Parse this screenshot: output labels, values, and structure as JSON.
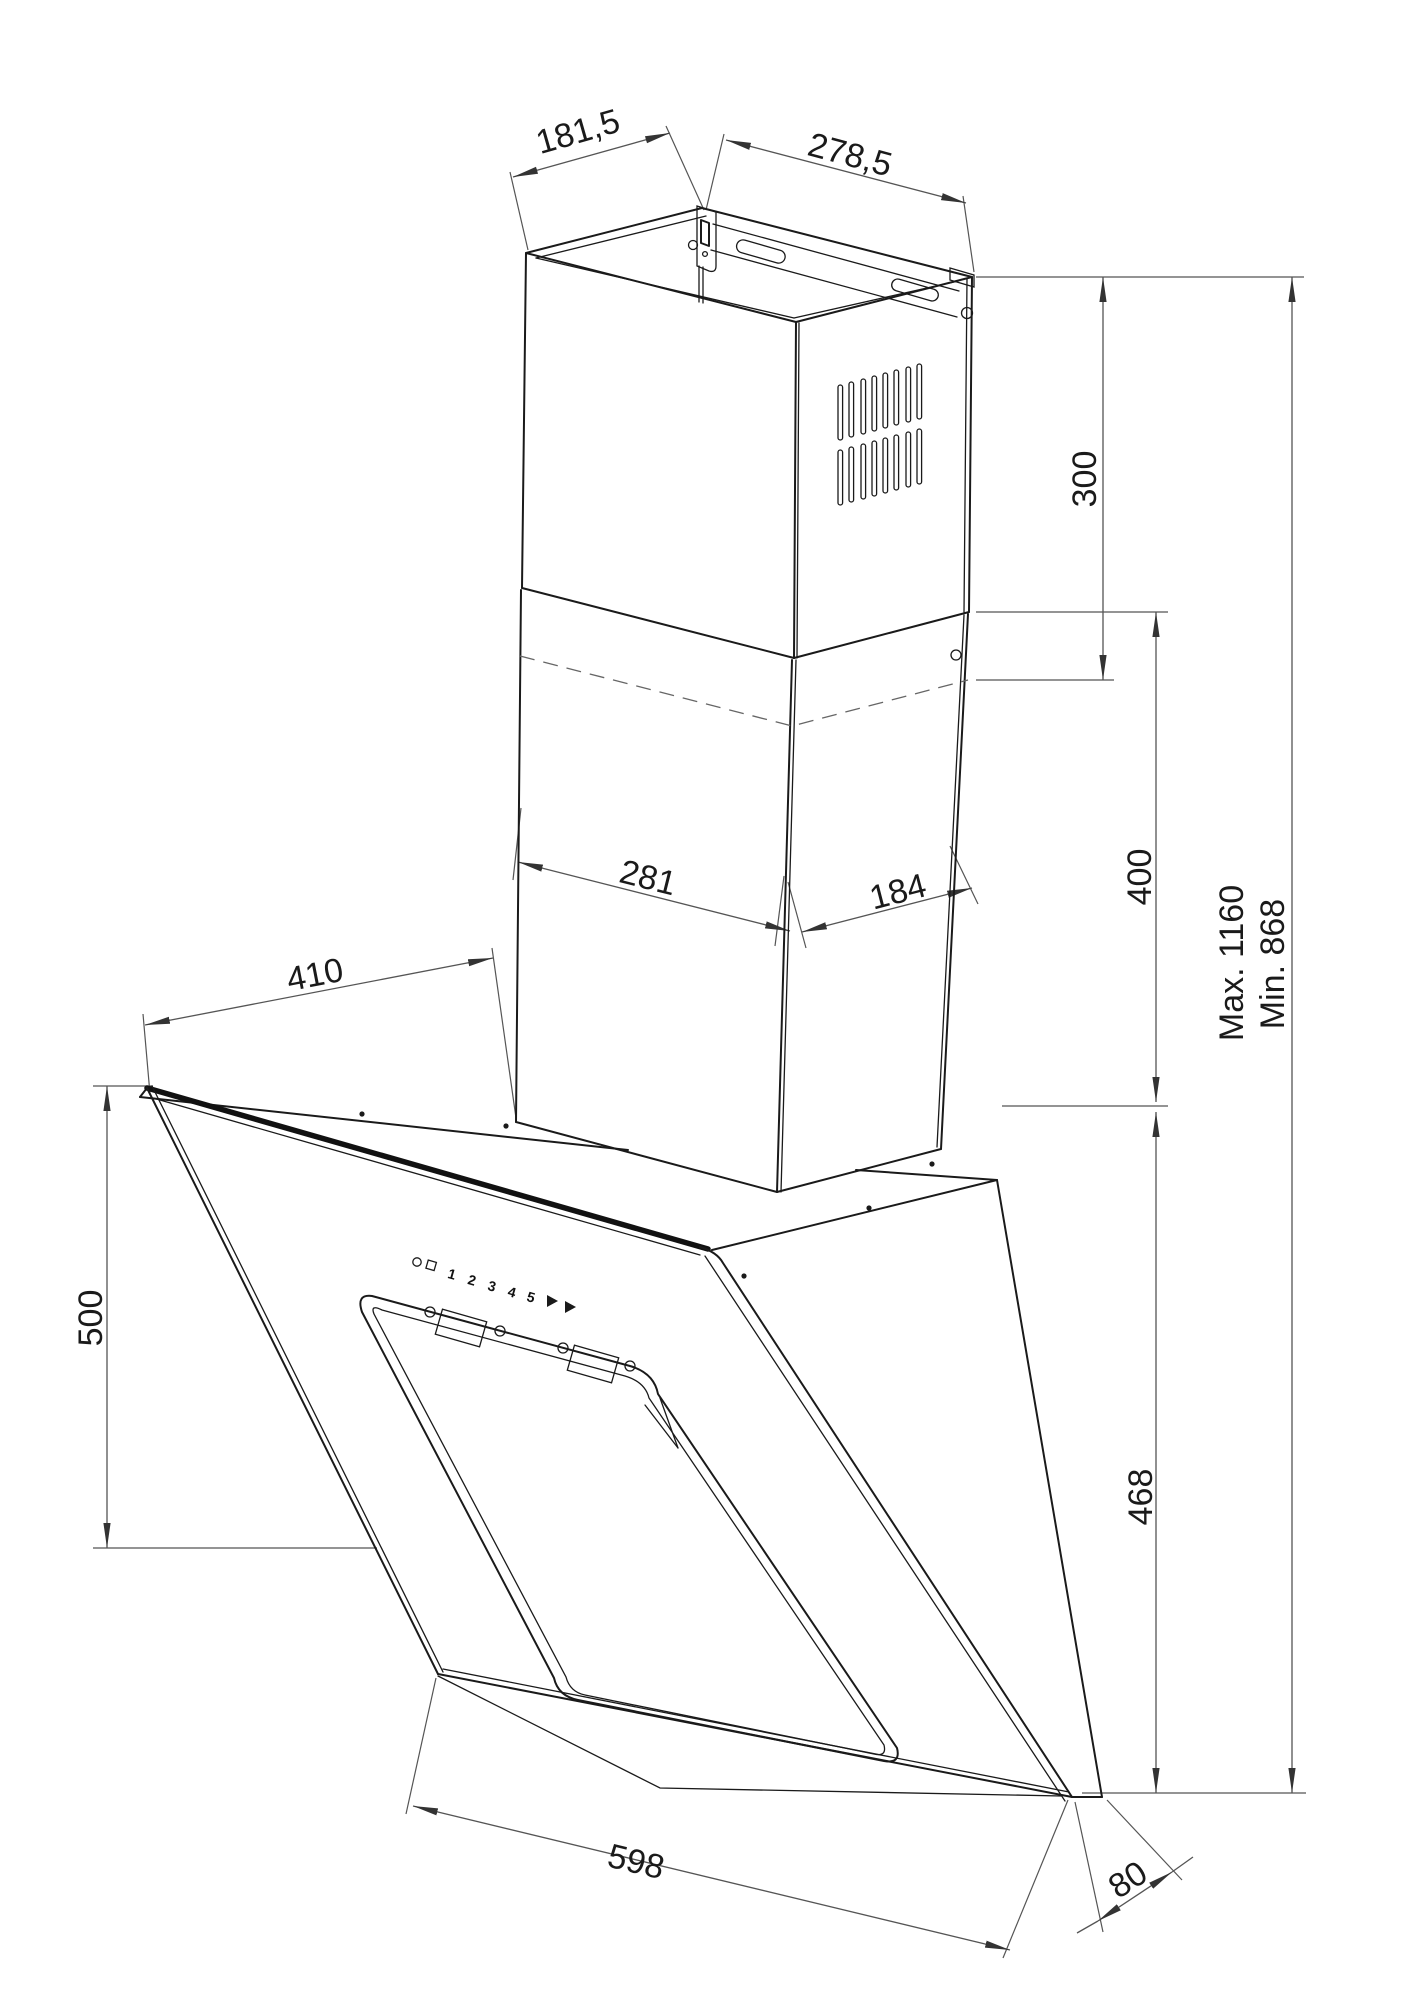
{
  "dims": {
    "d181": "181,5",
    "d278": "278,5",
    "d300": "300",
    "d400": "400",
    "d468": "468",
    "dmax": "Max. 1160",
    "dmin": "Min. 868",
    "d281": "281",
    "d184": "184",
    "d410": "410",
    "d500": "500",
    "d598": "598",
    "d80": "80"
  },
  "controls": {
    "power_icon": "power-circle-icon",
    "light_icon": "light-square-icon",
    "speeds": [
      "1",
      "2",
      "3",
      "4",
      "5"
    ],
    "arrow_icons": "speed-arrow-icons"
  },
  "colors": {
    "line": "#1a1a1a",
    "dimension": "#555555",
    "background": "#ffffff"
  }
}
